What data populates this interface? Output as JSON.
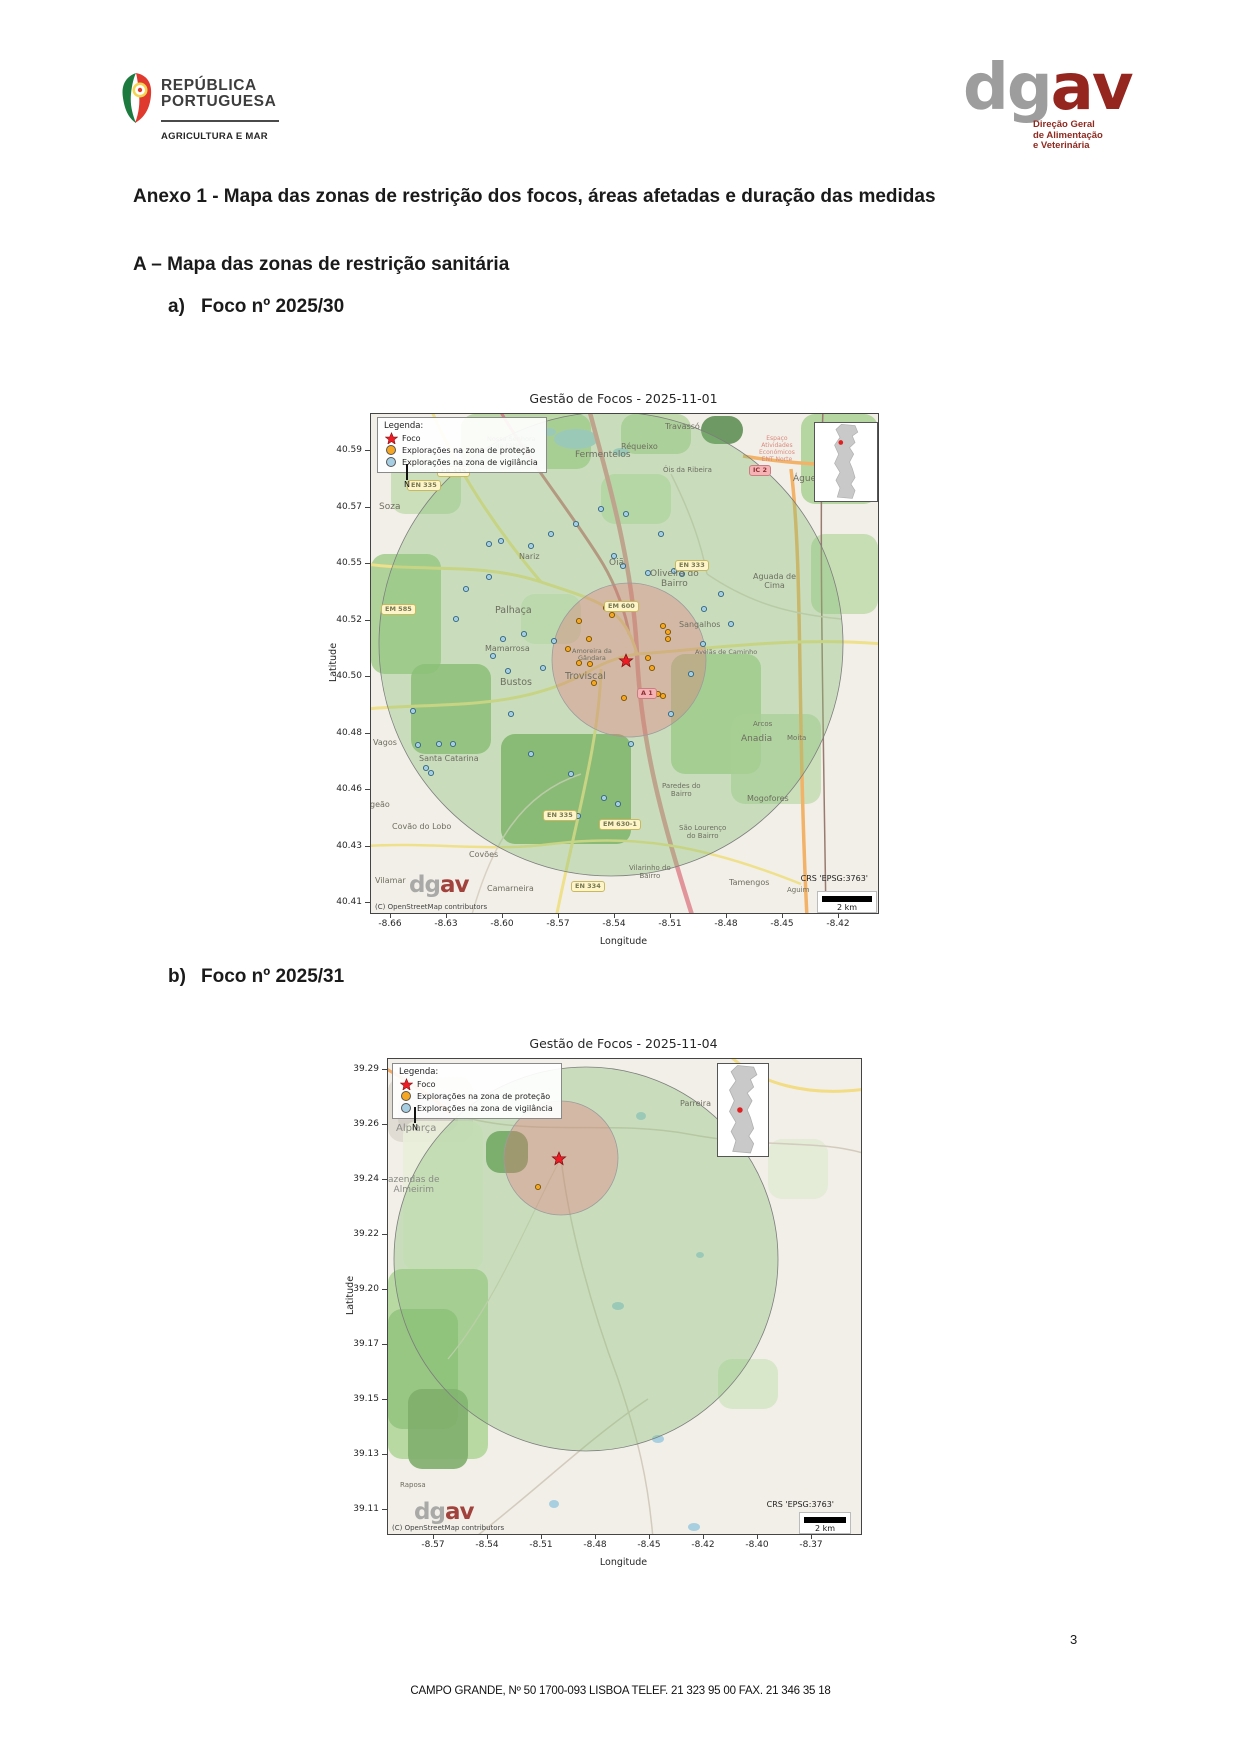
{
  "header": {
    "gov_logo": {
      "line1": "REPÚBLICA",
      "line2": "PORTUGUESA",
      "subtitle": "AGRICULTURA E MAR"
    },
    "dgav_logo": {
      "gray": "dg",
      "red": "av",
      "caption_lines": [
        "Direção Geral",
        "de Alimentação",
        "e Veterinária"
      ]
    }
  },
  "title": "Anexo 1 - Mapa das zonas de restrição dos focos, áreas afetadas e duração das medidas",
  "section_a": "A – Mapa das zonas de restrição sanitária",
  "items": [
    {
      "marker": "a)",
      "label": "Foco nº 2025/30"
    },
    {
      "marker": "b)",
      "label": "Foco nº 2025/31"
    }
  ],
  "footer": {
    "address": "CAMPO GRANDE, Nº 50 1700-093 LISBOA TELEF. 21 323 95 00 FAX. 21 346 35 18",
    "page": "3"
  },
  "colors": {
    "focus_star": "#ed1c24",
    "protection_dot": "#f5a623",
    "surveillance_dot": "#a6cee3",
    "protection_zone_fill": "rgba(231,112,118,0.33)",
    "surveillance_zone_fill": "rgba(134,193,117,0.38)"
  },
  "maps": [
    {
      "title": "Gestão de Focos - 2025-11-01",
      "xlabel": "Longitude",
      "ylabel": "Latitude",
      "yticks": [
        "40.59",
        "40.57",
        "40.55",
        "40.52",
        "40.50",
        "40.48",
        "40.46",
        "40.43",
        "40.41"
      ],
      "xticks": [
        "-8.66",
        "-8.63",
        "-8.60",
        "-8.57",
        "-8.54",
        "-8.51",
        "-8.48",
        "-8.45",
        "-8.42"
      ],
      "legend": {
        "title": "Legenda:",
        "items": [
          {
            "label": "Foco",
            "type": "star"
          },
          {
            "label": "Explorações na zona de proteção",
            "type": "protection"
          },
          {
            "label": "Explorações na zona de vigilância",
            "type": "surveillance"
          }
        ]
      },
      "north_label": "N",
      "crs": "CRS 'EPSG:3763'",
      "scale_label": "2 km",
      "watermark": {
        "gray": "dg",
        "red": "av"
      },
      "copyright": "(C) OpenStreetMap contributors",
      "zones": {
        "surveillance": {
          "cx": 240,
          "cy": 230,
          "r": 232
        },
        "protection": {
          "cx": 258,
          "cy": 246,
          "r": 77
        }
      },
      "focus": {
        "x": 255,
        "y": 247
      },
      "protection_dots": [
        [
          208,
          207
        ],
        [
          218,
          225
        ],
        [
          235,
          194
        ],
        [
          241,
          201
        ],
        [
          197,
          235
        ],
        [
          208,
          249
        ],
        [
          219,
          250
        ],
        [
          277,
          244
        ],
        [
          281,
          254
        ],
        [
          292,
          212
        ],
        [
          297,
          218
        ],
        [
          297,
          225
        ],
        [
          287,
          280
        ],
        [
          292,
          282
        ],
        [
          223,
          269
        ],
        [
          253,
          284
        ]
      ],
      "surveillance_dots": [
        [
          118,
          130
        ],
        [
          130,
          127
        ],
        [
          160,
          132
        ],
        [
          243,
          142
        ],
        [
          252,
          152
        ],
        [
          277,
          159
        ],
        [
          303,
          157
        ],
        [
          311,
          160
        ],
        [
          333,
          195
        ],
        [
          153,
          220
        ],
        [
          132,
          225
        ],
        [
          172,
          254
        ],
        [
          122,
          242
        ],
        [
          137,
          257
        ],
        [
          183,
          227
        ],
        [
          42,
          297
        ],
        [
          68,
          330
        ],
        [
          82,
          330
        ],
        [
          47,
          331
        ],
        [
          55,
          354
        ],
        [
          60,
          359
        ],
        [
          207,
          402
        ],
        [
          233,
          384
        ],
        [
          118,
          163
        ],
        [
          95,
          175
        ],
        [
          85,
          205
        ],
        [
          140,
          300
        ],
        [
          160,
          340
        ],
        [
          200,
          360
        ],
        [
          260,
          330
        ],
        [
          300,
          300
        ],
        [
          320,
          260
        ],
        [
          332,
          230
        ],
        [
          290,
          120
        ],
        [
          255,
          100
        ],
        [
          230,
          95
        ],
        [
          205,
          110
        ],
        [
          180,
          120
        ],
        [
          350,
          180
        ],
        [
          360,
          210
        ],
        [
          247,
          390
        ]
      ],
      "places": [
        {
          "t": "Travassó",
          "x": 296,
          "y": 8
        },
        {
          "t": "Réqueixo",
          "x": 252,
          "y": 28
        },
        {
          "t": "Óis da Ribeira",
          "x": 294,
          "y": 52,
          "s": 7
        },
        {
          "t": "Fermentelos",
          "x": 206,
          "y": 36,
          "s": 9
        },
        {
          "t": "Nossa Senhora\nde Fátima",
          "x": 118,
          "y": 22,
          "s": 6.5
        },
        {
          "t": "Águeda",
          "x": 424,
          "y": 60,
          "s": 9
        },
        {
          "t": "Soza",
          "x": 10,
          "y": 88,
          "s": 9
        },
        {
          "t": "Nariz",
          "x": 150,
          "y": 138
        },
        {
          "t": "Oiã",
          "x": 240,
          "y": 144,
          "s": 9
        },
        {
          "t": "Palhaça",
          "x": 126,
          "y": 192,
          "s": 9.5
        },
        {
          "t": "Oliveira do\nBairro",
          "x": 281,
          "y": 155,
          "s": 9
        },
        {
          "t": "Aguada de\nCima",
          "x": 384,
          "y": 158,
          "s": 8
        },
        {
          "t": "Sangalhos",
          "x": 310,
          "y": 206
        },
        {
          "t": "Bustos",
          "x": 131,
          "y": 264,
          "s": 9.5
        },
        {
          "t": "Troviscal",
          "x": 196,
          "y": 258,
          "s": 9.5
        },
        {
          "t": "Mamarrosa",
          "x": 116,
          "y": 230
        },
        {
          "t": "Amoreira da\nGândara",
          "x": 203,
          "y": 234,
          "s": 6.5
        },
        {
          "t": "Avelãs de Caminho",
          "x": 326,
          "y": 235,
          "s": 6.5
        },
        {
          "t": "Anadia",
          "x": 372,
          "y": 320,
          "s": 9
        },
        {
          "t": "Arcos",
          "x": 384,
          "y": 306,
          "s": 7
        },
        {
          "t": "Moita",
          "x": 418,
          "y": 320,
          "s": 7
        },
        {
          "t": "Vagos",
          "x": 4,
          "y": 324
        },
        {
          "t": "Santa Catarina",
          "x": 50,
          "y": 340
        },
        {
          "t": "geão",
          "x": 1,
          "y": 386
        },
        {
          "t": "Covão do Lobo",
          "x": 23,
          "y": 408
        },
        {
          "t": "Paredes do\nBairro",
          "x": 293,
          "y": 368,
          "s": 7
        },
        {
          "t": "Mogofores",
          "x": 378,
          "y": 380
        },
        {
          "t": "São Lourenço\ndo Bairro",
          "x": 310,
          "y": 410,
          "s": 7
        },
        {
          "t": "Covões",
          "x": 100,
          "y": 436
        },
        {
          "t": "Vilamar",
          "x": 6,
          "y": 462
        },
        {
          "t": "Camarneira",
          "x": 118,
          "y": 470
        },
        {
          "t": "Vilarinho do\nBairro",
          "x": 260,
          "y": 450,
          "s": 7
        },
        {
          "t": "Tamengos",
          "x": 360,
          "y": 464
        },
        {
          "t": "Aguim",
          "x": 418,
          "y": 472,
          "s": 7
        },
        {
          "t": "Espaço\nAtividades\nEconómicos\nENT Norte",
          "x": 390,
          "y": 22,
          "s": 6,
          "c": "#d98a7e"
        }
      ],
      "badges": [
        {
          "t": "ER 335",
          "x": 66,
          "y": 52,
          "k": "y"
        },
        {
          "t": "EN 335",
          "x": 36,
          "y": 66,
          "k": "y"
        },
        {
          "t": "IC 2",
          "x": 378,
          "y": 51,
          "k": "r"
        },
        {
          "t": "EN 333",
          "x": 304,
          "y": 146,
          "k": "y"
        },
        {
          "t": "EM 600",
          "x": 233,
          "y": 187,
          "k": "y"
        },
        {
          "t": "EM 585",
          "x": 10,
          "y": 190,
          "k": "y"
        },
        {
          "t": "A 1",
          "x": 266,
          "y": 274,
          "k": "r"
        },
        {
          "t": "EN 335",
          "x": 172,
          "y": 396,
          "k": "y"
        },
        {
          "t": "EM 630-1",
          "x": 228,
          "y": 405,
          "k": "y"
        },
        {
          "t": "EN 334",
          "x": 200,
          "y": 467,
          "k": "y"
        }
      ],
      "terrain": [
        {
          "x": 90,
          "y": 0,
          "w": 130,
          "h": 55,
          "c": "#aed296",
          "o": 0.8
        },
        {
          "x": 250,
          "y": 0,
          "w": 70,
          "h": 40,
          "c": "#aed296",
          "o": 0.7
        },
        {
          "x": 330,
          "y": 2,
          "w": 42,
          "h": 28,
          "c": "#5f8f55",
          "o": 0.9
        },
        {
          "x": 430,
          "y": 0,
          "w": 77,
          "h": 90,
          "c": "#a6cf8f",
          "o": 0.8
        },
        {
          "x": 440,
          "y": 120,
          "w": 67,
          "h": 80,
          "c": "#bcd9a8",
          "o": 0.8
        },
        {
          "x": 20,
          "y": 40,
          "w": 70,
          "h": 60,
          "c": "#bcd9a8",
          "o": 0.7
        },
        {
          "x": 0,
          "y": 140,
          "w": 70,
          "h": 120,
          "c": "#9ccb86",
          "o": 0.8
        },
        {
          "x": 40,
          "y": 250,
          "w": 80,
          "h": 90,
          "c": "#8fbf78",
          "o": 0.85
        },
        {
          "x": 130,
          "y": 320,
          "w": 130,
          "h": 110,
          "c": "#7fb069",
          "o": 0.9
        },
        {
          "x": 230,
          "y": 60,
          "w": 70,
          "h": 50,
          "c": "#c4dfb2",
          "o": 0.7
        },
        {
          "x": 300,
          "y": 240,
          "w": 90,
          "h": 120,
          "c": "#a6cf8f",
          "o": 0.75
        },
        {
          "x": 360,
          "y": 300,
          "w": 90,
          "h": 90,
          "c": "#bcd9a8",
          "o": 0.7
        },
        {
          "x": 150,
          "y": 180,
          "w": 60,
          "h": 50,
          "c": "#d2e5c3",
          "o": 0.7
        }
      ],
      "roads": [
        {
          "d": "M 128,-5 C 160,50 205,105 232,150 C 245,172 255,200 258,220",
          "c": "#cf8287",
          "w": 3
        },
        {
          "d": "M 218,-5 C 238,70 262,150 266,240 C 270,330 292,410 322,504",
          "c": "#e2949b",
          "w": 4.5
        },
        {
          "d": "M 420,55 C 432,150 426,300 436,504",
          "c": "#f2b267",
          "w": 3.5
        },
        {
          "d": "M 372,42 C 420,50 460,52 512,50",
          "c": "#f2b267",
          "w": 3.5
        },
        {
          "d": "M 452,-5 C 448,100 452,300 455,504",
          "c": "#9a7a70",
          "w": 1.5
        },
        {
          "d": "M -5,150 C 50,158 110,148 170,168 C 230,188 252,192 266,240",
          "c": "#efe08b",
          "w": 3
        },
        {
          "d": "M 60,-5 C 85,55 125,115 170,168",
          "c": "#efe08b",
          "w": 3
        },
        {
          "d": "M -5,295 C 70,288 150,298 222,255 C 240,245 255,242 266,240",
          "c": "#efe08b",
          "w": 3
        },
        {
          "d": "M 266,240 C 330,236 420,222 512,230",
          "c": "#efe08b",
          "w": 3
        },
        {
          "d": "M 230,255 C 228,330 205,405 185,504",
          "c": "#efe08b",
          "w": 3
        },
        {
          "d": "M -5,432 C 60,428 120,438 180,430 C 260,420 330,430 430,470",
          "c": "#efe08b",
          "w": 2.5
        },
        {
          "d": "M 100,504 C 120,430 150,380 210,360",
          "c": "#d9d2c4",
          "w": 1.5
        },
        {
          "d": "M 300,60 C 320,100 330,130 336,160",
          "c": "#d9d2c4",
          "w": 1.5
        },
        {
          "d": "M 336,160 C 380,190 420,200 470,205",
          "c": "#d9d2c4",
          "w": 1.5
        }
      ],
      "waters": [
        {
          "x": 205,
          "y": 25,
          "rx": 22,
          "ry": 10
        },
        {
          "x": 250,
          "y": 38,
          "rx": 8,
          "ry": 4
        },
        {
          "x": 178,
          "y": 18,
          "rx": 7,
          "ry": 4
        }
      ]
    },
    {
      "title": "Gestão de Focos - 2025-11-04",
      "xlabel": "Longitude",
      "ylabel": "Latitude",
      "yticks": [
        "39.29",
        "39.26",
        "39.24",
        "39.22",
        "39.20",
        "39.17",
        "39.15",
        "39.13",
        "39.11"
      ],
      "xticks": [
        "-8.57",
        "-8.54",
        "-8.51",
        "-8.48",
        "-8.45",
        "-8.42",
        "-8.40",
        "-8.37"
      ],
      "legend": {
        "title": "Legenda:",
        "items": [
          {
            "label": "Foco",
            "type": "star"
          },
          {
            "label": "Explorações na zona de proteção",
            "type": "protection"
          },
          {
            "label": "Explorações na zona de vigilância",
            "type": "surveillance"
          }
        ]
      },
      "north_label": "N",
      "crs": "CRS 'EPSG:3763'",
      "scale_label": "2 km",
      "watermark": {
        "gray": "dg",
        "red": "av"
      },
      "copyright": "(C) OpenStreetMap contributors",
      "zones": {
        "surveillance": {
          "cx": 198,
          "cy": 200,
          "r": 192
        },
        "protection": {
          "cx": 173,
          "cy": 99,
          "r": 57
        }
      },
      "focus": {
        "x": 171,
        "y": 100
      },
      "protection_dots": [
        [
          150,
          128
        ]
      ],
      "surveillance_dots": [],
      "places": [
        {
          "t": "Alpiarça",
          "x": 10,
          "y": 64,
          "s": 10,
          "c": "#8a8a85"
        },
        {
          "t": "Parreira",
          "x": 294,
          "y": 40,
          "s": 8
        },
        {
          "t": "azendas de\nAlmeirim",
          "x": 2,
          "y": 116,
          "s": 9,
          "c": "#8a8a85"
        },
        {
          "t": "Raposa",
          "x": 14,
          "y": 422,
          "s": 7
        }
      ],
      "badges": [],
      "terrain": [
        {
          "x": 0,
          "y": 18,
          "w": 85,
          "h": 65,
          "c": "#ded9d2",
          "o": 0.9
        },
        {
          "x": 10,
          "y": 34,
          "w": 60,
          "h": 40,
          "c": "#d2ccc4",
          "o": 0.9
        },
        {
          "x": 15,
          "y": 62,
          "w": 80,
          "h": 150,
          "c": "#e9eed9",
          "o": 0.9
        },
        {
          "x": 0,
          "y": 210,
          "w": 100,
          "h": 190,
          "c": "#b2d69b",
          "o": 0.9
        },
        {
          "x": 0,
          "y": 250,
          "w": 70,
          "h": 120,
          "c": "#94c47e",
          "o": 0.9
        },
        {
          "x": 20,
          "y": 330,
          "w": 60,
          "h": 80,
          "c": "#7fae6b",
          "o": 0.9
        },
        {
          "x": 98,
          "y": 72,
          "w": 42,
          "h": 42,
          "c": "#6f9e63",
          "o": 0.95
        },
        {
          "x": 330,
          "y": 300,
          "w": 60,
          "h": 50,
          "c": "#cde4bd",
          "o": 0.7
        },
        {
          "x": 380,
          "y": 80,
          "w": 60,
          "h": 60,
          "c": "#dbe9cd",
          "o": 0.6
        }
      ],
      "roads": [
        {
          "d": "M -5,8 C 25,25 45,38 62,54",
          "c": "#f0aa66",
          "w": 3
        },
        {
          "d": "M 340,-5 C 370,25 420,38 478,30",
          "c": "#f2dc84",
          "w": 3
        },
        {
          "d": "M 62,54 C 140,80 220,60 300,75 C 380,90 430,80 478,95",
          "c": "#d3cbbd",
          "w": 1.5
        },
        {
          "d": "M 85,480 C 150,430 200,380 260,340",
          "c": "#d3cbbd",
          "w": 1.5
        },
        {
          "d": "M 173,99 C 180,160 200,240 230,320 C 250,380 260,420 265,480",
          "c": "#d3cbbd",
          "w": 1.5
        },
        {
          "d": "M 173,99 C 140,160 110,240 60,300",
          "c": "#ddd5c8",
          "w": 1.2
        }
      ],
      "waters": [
        {
          "x": 253,
          "y": 57,
          "rx": 5,
          "ry": 4
        },
        {
          "x": 230,
          "y": 247,
          "rx": 6,
          "ry": 4
        },
        {
          "x": 312,
          "y": 196,
          "rx": 4,
          "ry": 3
        },
        {
          "x": 270,
          "y": 380,
          "rx": 6,
          "ry": 4
        },
        {
          "x": 166,
          "y": 445,
          "rx": 5,
          "ry": 4
        },
        {
          "x": 306,
          "y": 468,
          "rx": 6,
          "ry": 4
        }
      ]
    }
  ]
}
